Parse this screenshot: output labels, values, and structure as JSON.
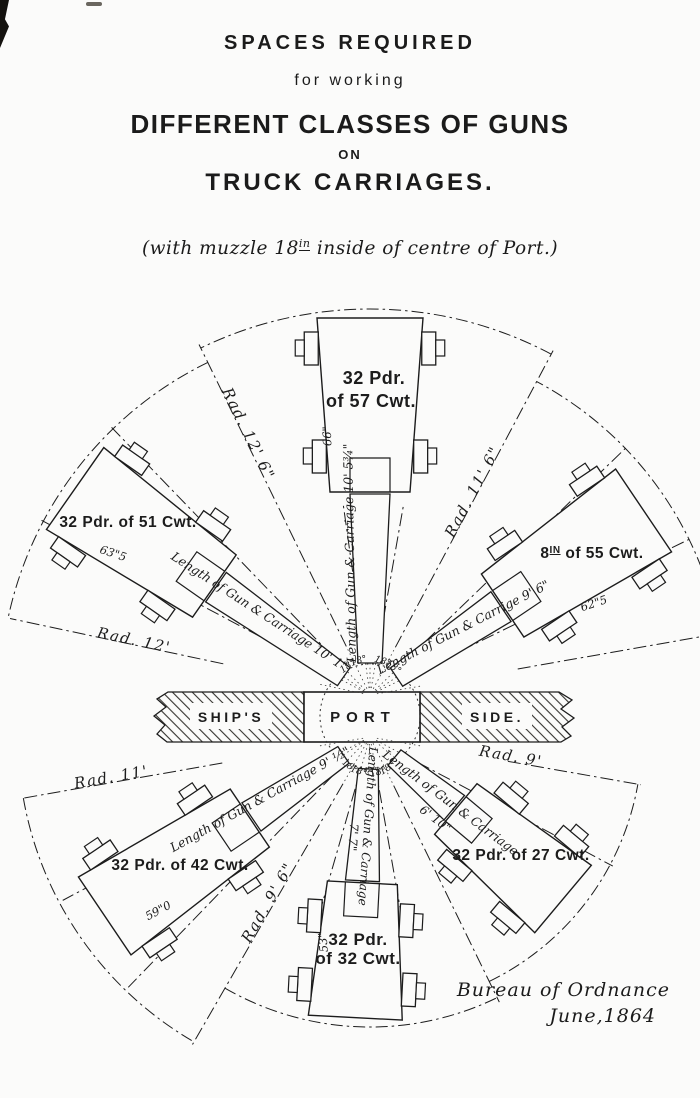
{
  "title": {
    "line1": "SPACES REQUIRED",
    "line2": "for working",
    "line3": "DIFFERENT CLASSES OF GUNS",
    "line4": "ON",
    "line5": "TRUCK CARRIAGES.",
    "subtitle_pre": "(with muzzle 18",
    "subtitle_sup": "in",
    "subtitle_post": " inside of centre of Port.)"
  },
  "band": {
    "ships": "SHIP'S",
    "port": "PORT",
    "side": "SIDE."
  },
  "center": {
    "angle_label": "18°"
  },
  "guns": [
    {
      "id": "32pdr-57cwt",
      "name_lines": [
        "32 Pdr.",
        "of 57 Cwt."
      ],
      "width_label": "66\"",
      "length_label": "Length of Gun & Carriage 10' 5¾\"",
      "radius_label": "Rad. 12' 6\""
    },
    {
      "id": "32pdr-51cwt",
      "name_lines": [
        "32 Pdr. of 51 Cwt."
      ],
      "width_label": "63\"5",
      "length_label": "Length of Gun & Carriage 10' 1\"",
      "radius_label": "Rad. 12'"
    },
    {
      "id": "8in-55cwt",
      "name_pre": "8",
      "name_sup": "IN",
      "name_post": " of 55 Cwt.",
      "width_label": "62\"5",
      "length_label": "Length of Gun & Carrige 9' 6\"",
      "radius_label": "Rad. 11' 6\""
    },
    {
      "id": "32pdr-42cwt",
      "name_lines": [
        "32 Pdr. of 42 Cwt."
      ],
      "width_label": "59\"0",
      "length_label": "Length of Gun & Carriage 9' ½\"",
      "radius_label": "Rad. 11'"
    },
    {
      "id": "32pdr-32cwt",
      "name_lines": [
        "32 Pdr.",
        "of 32 Cwt."
      ],
      "width_label": "53\"",
      "length_label": "Length of Gun & Carriage",
      "length_label2": "7' 7\"",
      "radius_label": "Rad. 9' 6\""
    },
    {
      "id": "32pdr-27cwt",
      "name_lines": [
        "32 Pdr. of 27 Cwt."
      ],
      "length_label": "Length of Gun & Carriage",
      "length_label2": "6' 10\"",
      "radius_label": "Rad. 9'"
    }
  ],
  "attribution": {
    "line1": "Bureau of Ordnance",
    "line2": "June,1864"
  }
}
